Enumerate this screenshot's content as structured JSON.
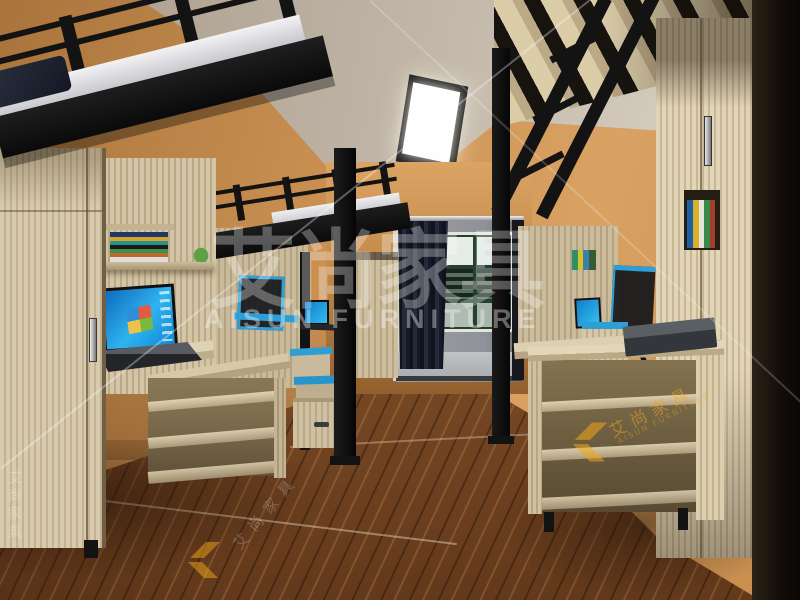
{
  "image": {
    "subject": "3D rendering of a dormitory room with black metal loft beds over wooden desks, wardrobes, shelving and laptops"
  },
  "watermark": {
    "brand_cn": "艾尚家具",
    "brand_en": "AISUN FURNITURE",
    "logo_monogram_icon": "as-logo-icon",
    "accent_yellow": "#f0a818",
    "overlay_white": "rgba(255,255,255,0.30)"
  },
  "palette": {
    "wall_orange": "#c98f51",
    "ceiling_gray": "#c2b8aa",
    "metal_black": "#141414",
    "wood_light": "#d8cbad",
    "floor_brown": "#7c4f27",
    "screen_blue": "#18a8e8",
    "trim_blue": "#2e9fd6",
    "curtain_dark": "#161925",
    "window_green": "#2b4a38"
  }
}
